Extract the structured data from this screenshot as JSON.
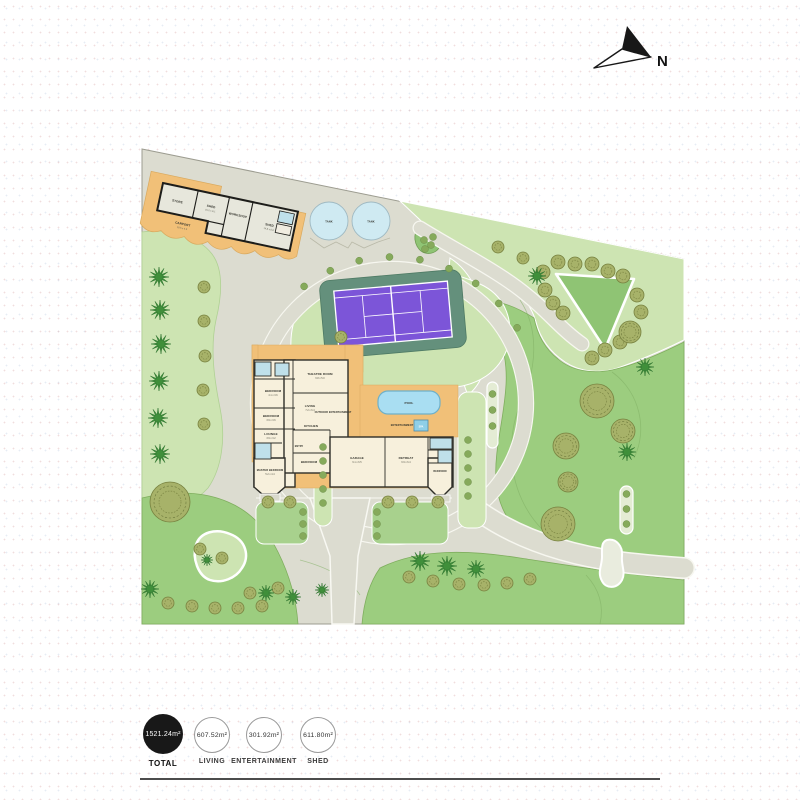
{
  "north": {
    "label": "N"
  },
  "legend": {
    "items": [
      {
        "value": "1521.24m²",
        "label": "TOTAL",
        "filled": true
      },
      {
        "value": "607.52m²",
        "label": "LIVING",
        "filled": false
      },
      {
        "value": "301.92m²",
        "label": "ENTERTAINMENT",
        "filled": false
      },
      {
        "value": "611.80m²",
        "label": "SHED",
        "filled": false
      }
    ]
  },
  "plan": {
    "shed": {
      "rooms": [
        {
          "name": "STORE"
        },
        {
          "name": "SHED",
          "dims": "15.2 x 8.1"
        },
        {
          "name": "WORKSHOP"
        },
        {
          "name": "SHED",
          "dims": "14.8 x 8.0"
        }
      ],
      "carport": {
        "name": "CARPORT",
        "dims": "19.5 x 4.6"
      }
    },
    "tanks": {
      "label": "TANK"
    },
    "house": {
      "rooms": [
        {
          "name": "THEATRE ROOM",
          "dims": "6.8 x 5.0"
        },
        {
          "name": "LIVING",
          "dims": "7.2 x 6.4"
        },
        {
          "name": "KITCHEN"
        },
        {
          "name": "BEDROOM",
          "dims": "4.1 x 3.6"
        },
        {
          "name": "BEDROOM",
          "dims": "3.9 x 3.6"
        },
        {
          "name": "LOUNGE",
          "dims": "3.9 x 3.2"
        },
        {
          "name": "MASTER BEDROOM",
          "dims": "5.2 x 4.4"
        },
        {
          "name": "BEDROOM"
        },
        {
          "name": "GARAGE",
          "dims": "9.1 x 6.5"
        },
        {
          "name": "RETREAT",
          "dims": "6.9 x 6.4"
        },
        {
          "name": "BEDROOM"
        },
        {
          "name": "ENTRY"
        }
      ],
      "deck_labels": [
        {
          "name": "OUTDOOR ENTERTAINMENT"
        },
        {
          "name": "ENTERTAINMENT"
        }
      ],
      "pool_label": "POOL",
      "spa_label": "SPA"
    }
  },
  "palette": {
    "site_base": "#dcdcd0",
    "lawn": "#9ccd7f",
    "lawn_light": "#cde4b2",
    "deck_orange": "#f1c078",
    "court_purple": "#7c55d8",
    "court_surround": "#64907c",
    "water_blue": "#bfe0ea",
    "pool_blue": "#a9def2",
    "tree_olive": "#a7b269",
    "palm_green": "#3f8f3a",
    "legend_black": "#181818"
  }
}
